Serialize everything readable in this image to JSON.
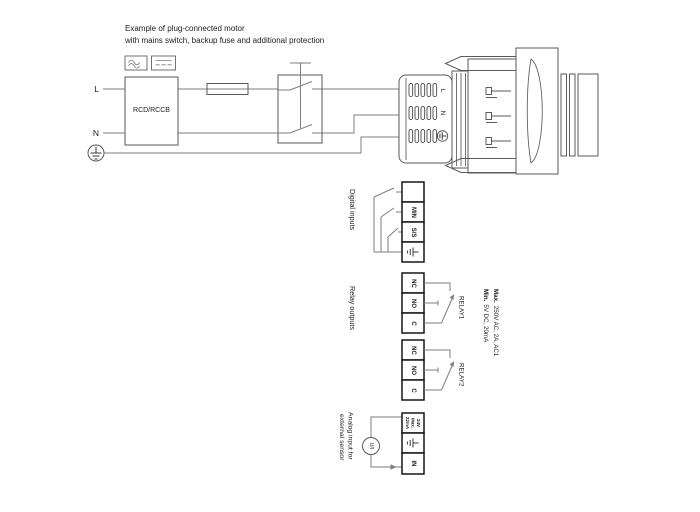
{
  "title": {
    "line1": "Example of plug-connected motor",
    "line2": "with mains switch, backup fuse and additional protection"
  },
  "mains": {
    "live_label": "L",
    "neutral_label": "N",
    "rcd_label": "RCD/RCCB",
    "ac_icon": "ac-wave-icon",
    "dc_icon": "dc-line-icon",
    "earth_icon": "protective-earth-icon"
  },
  "plug": {
    "live_label": "L",
    "neutral_label": "N",
    "earth_icon": "protective-earth-icon"
  },
  "digital_inputs": {
    "section_label": "Digital inputs",
    "terminals": [
      "",
      "MIN",
      "S/S"
    ],
    "earth_terminal_icon": "earth-terminal-icon"
  },
  "relay_outputs": {
    "section_label": "Relay outputs",
    "terminals": [
      "NC",
      "NO",
      "C"
    ],
    "relay1_label": "RELAY1",
    "relay2_label": "RELAY2",
    "spec_max_prefix": "Max.",
    "spec_max_rest": "250V AC, 2A, AC1",
    "spec_min_prefix": "Min.",
    "spec_min_rest": "5V DC, 20mA"
  },
  "analog_input": {
    "section_label_line1": "Analog input for",
    "section_label_line2": "external sensor",
    "sensor_label": "U/I",
    "supply_terminal_lines": [
      "24V",
      "Max.",
      "22mA"
    ],
    "in_terminal": "IN",
    "earth_terminal_icon": "earth-terminal-icon"
  },
  "colors": {
    "background": "#ffffff",
    "wire": "#7d7d7d",
    "component_outline": "#5a5a5a",
    "terminal_border": "#161616",
    "text": "#1c1c1c"
  }
}
